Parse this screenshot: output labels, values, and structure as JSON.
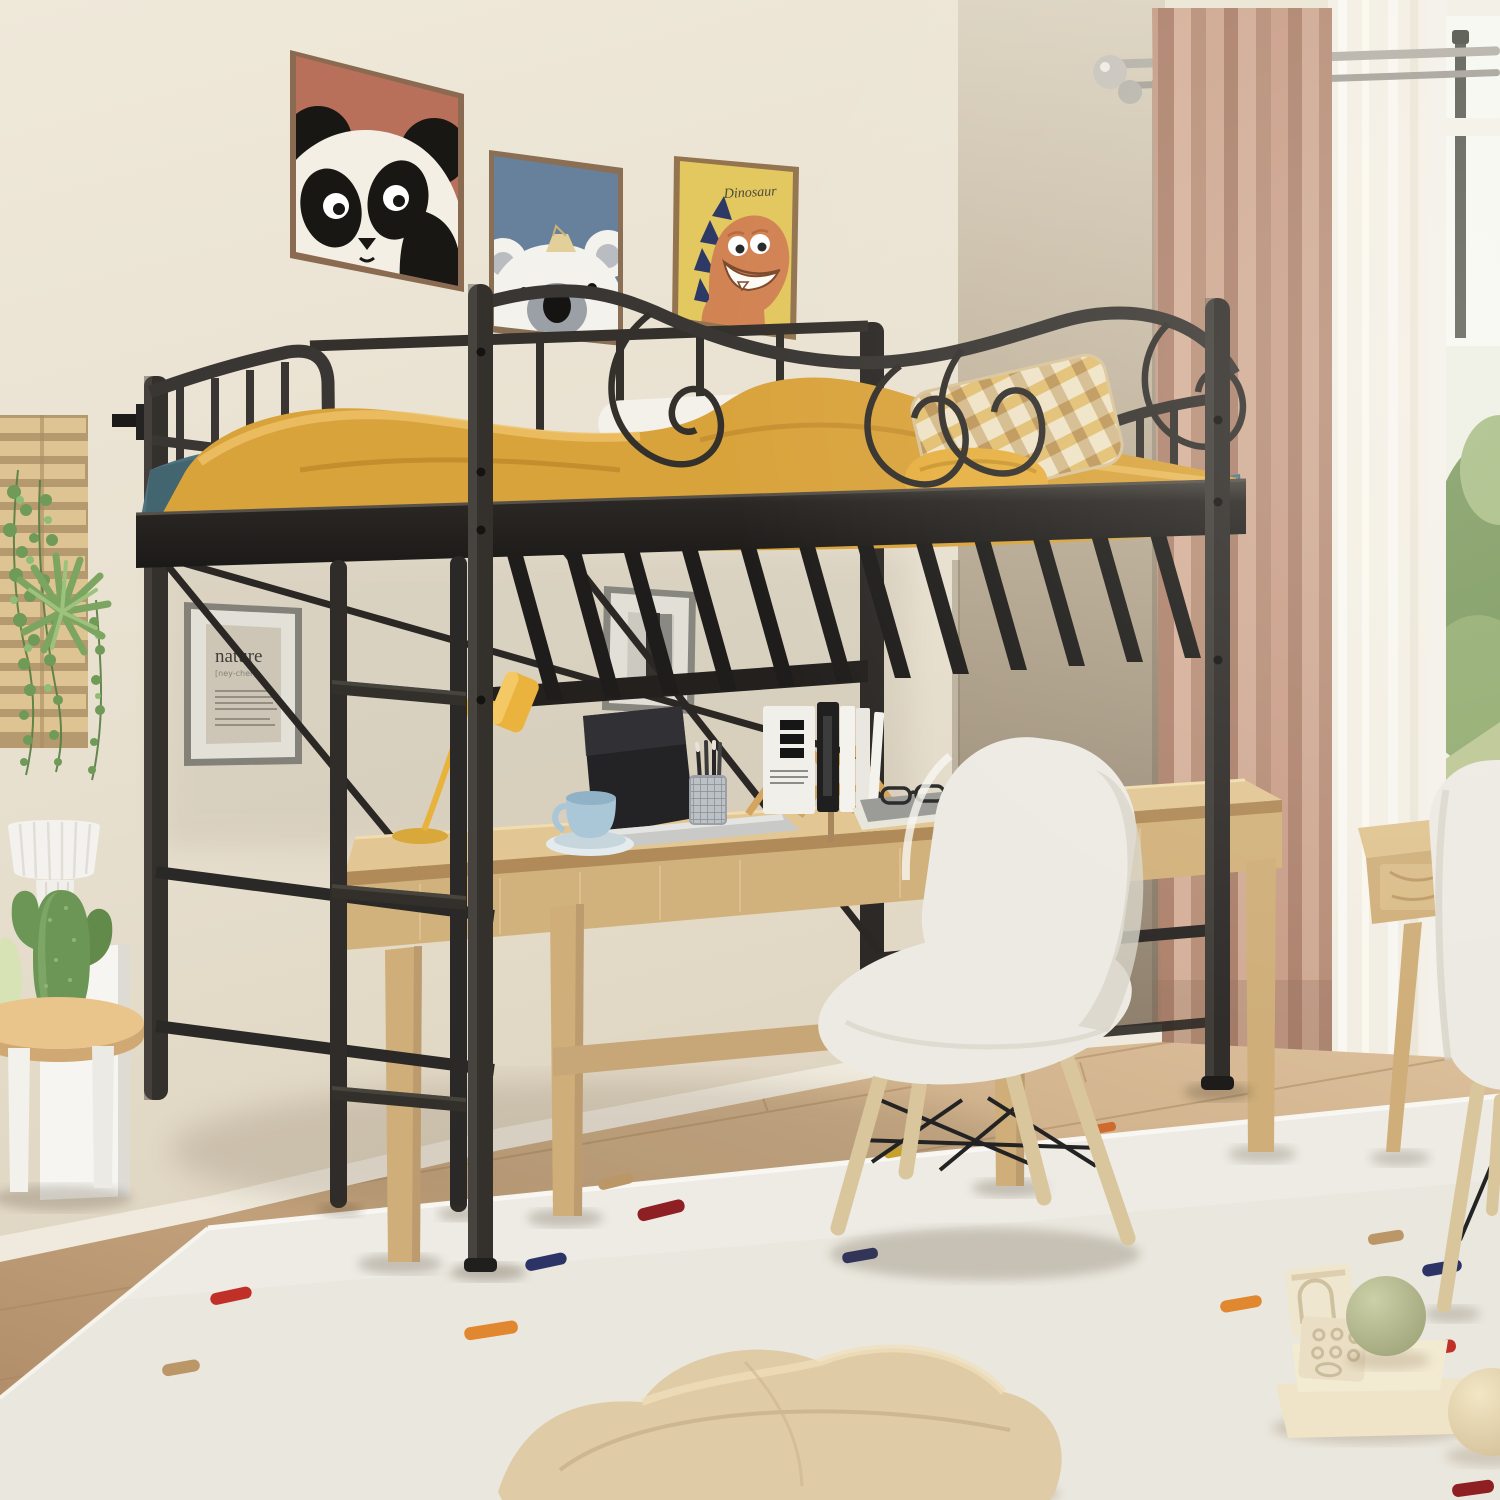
{
  "posters": {
    "dinosaur": {
      "label": "Dinosaur",
      "bg": "#e3c75f",
      "body": "#d28354",
      "spikes": "#2e3a66"
    },
    "panda": {
      "bg": "#b9705a"
    },
    "koala": {
      "bg": "#67809b"
    }
  },
  "nature_print": {
    "title": "nature",
    "pronunciation": "[ney-cher]"
  },
  "palette": {
    "wall": "#e9e2d2",
    "right_wall_dark": "#8c7e6b",
    "metal_frame": "#34302c",
    "mattress_teal": "#4d7280",
    "blanket_yellow": "#d9a33c",
    "desk_wood": "#dcbe8c",
    "chair_shell": "#edeae3",
    "curtain_tan": "#c59e88",
    "sheer": "#f4f0e6",
    "rug": "#eae7de",
    "floor_wood": "#c7a781",
    "plant_green": "#6f9a58"
  }
}
